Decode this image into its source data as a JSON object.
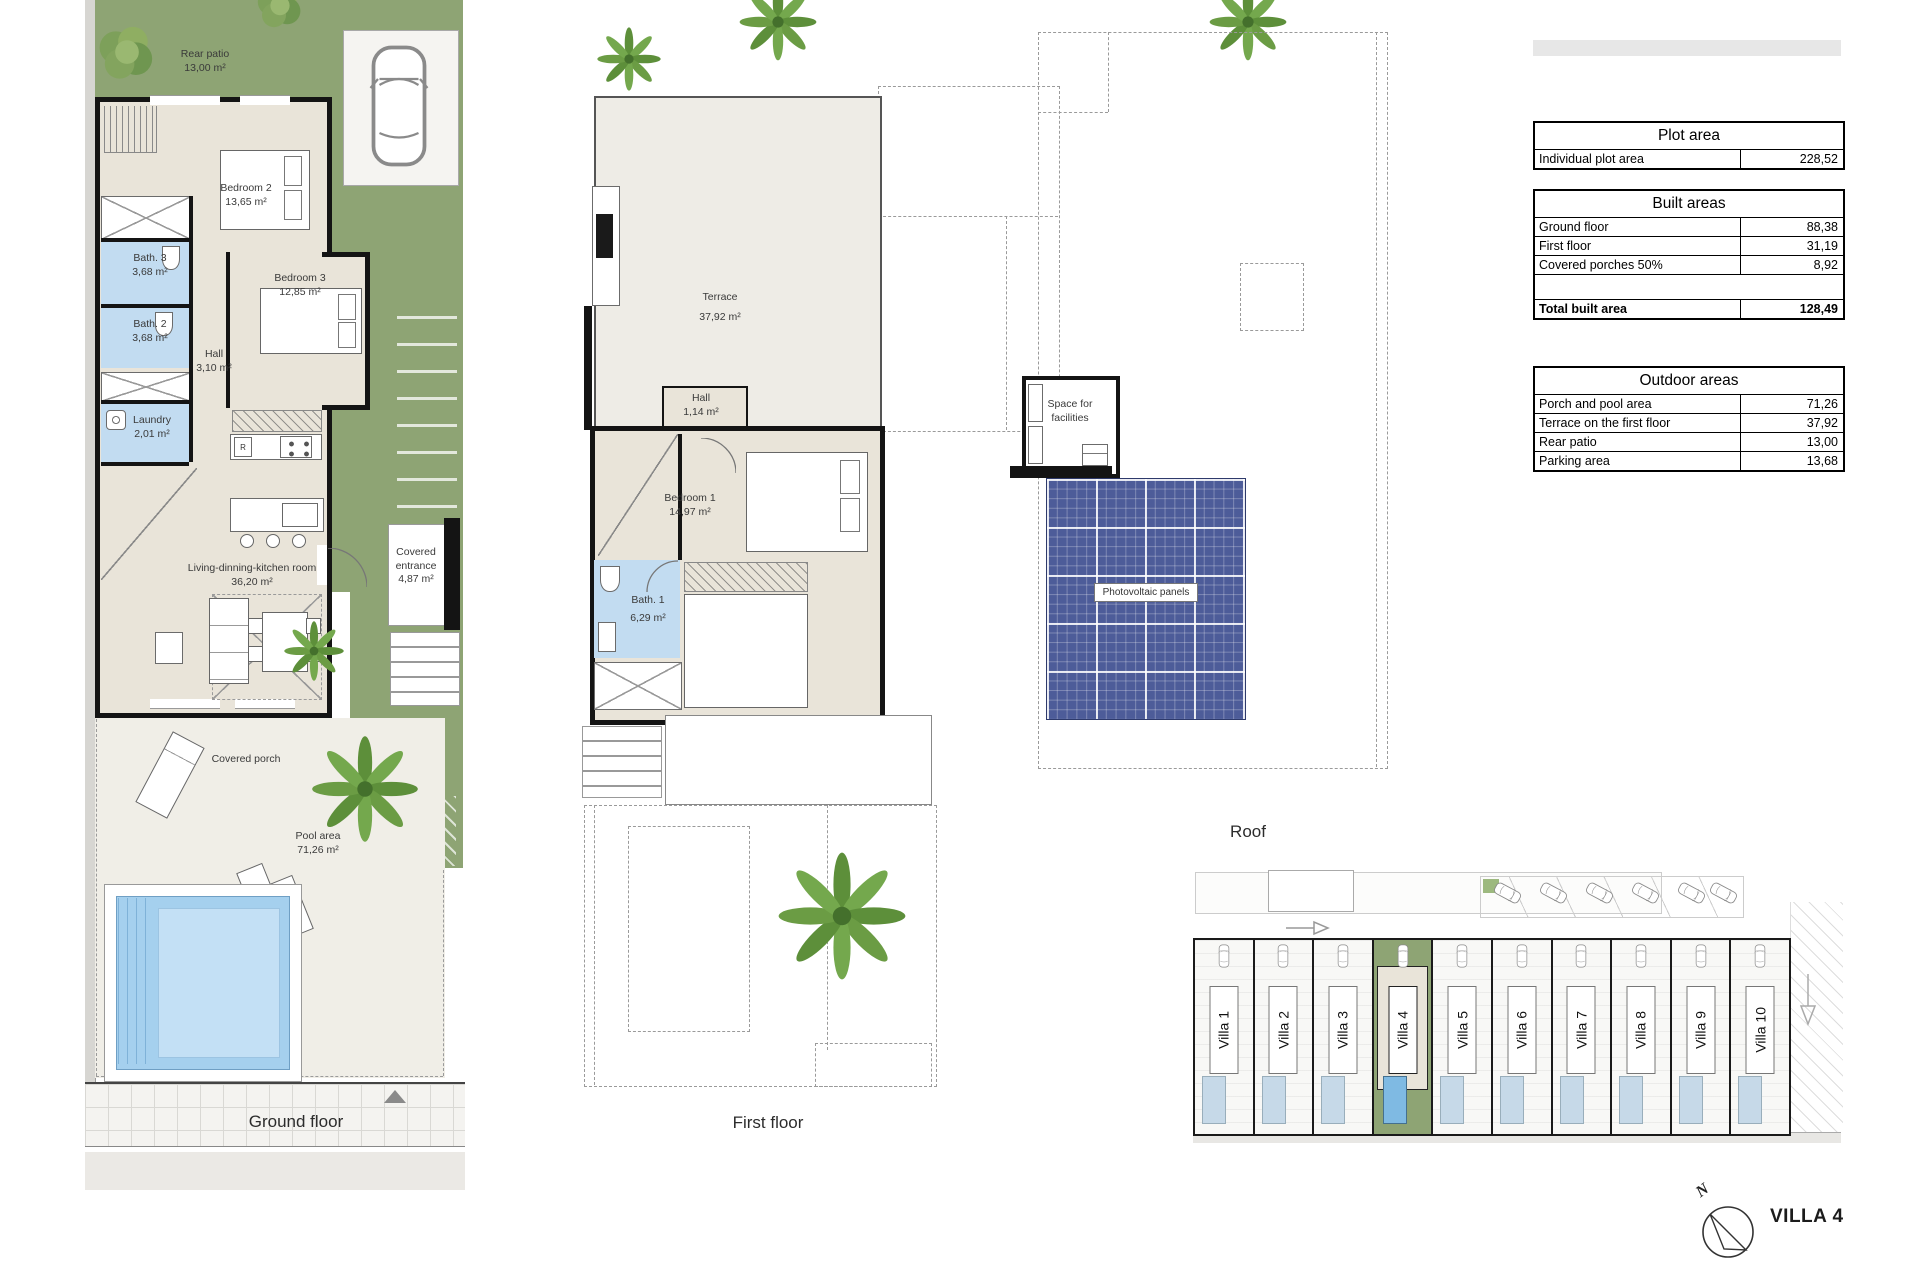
{
  "captions": {
    "ground_floor": "Ground floor",
    "first_floor": "First floor",
    "roof": "Roof"
  },
  "title": {
    "villa": "VILLA 4",
    "compass_north": "N"
  },
  "ground_floor": {
    "rear_patio": {
      "name": "Rear patio",
      "area": "13,00 m²"
    },
    "bedroom2": {
      "name": "Bedroom 2",
      "area": "13,65 m²"
    },
    "bath3": {
      "name": "Bath. 3",
      "area": "3,68 m²"
    },
    "bath2": {
      "name": "Bath. 2",
      "area": "3,68 m²"
    },
    "hall": {
      "name": "Hall",
      "area": "3,10 m²"
    },
    "bedroom3": {
      "name": "Bedroom 3",
      "area": "12,85 m²"
    },
    "laundry": {
      "name": "Laundry",
      "area": "2,01 m²"
    },
    "living": {
      "name": "Living-dinning-kitchen room",
      "area": "36,20 m²"
    },
    "covered_entrance": {
      "name": "Covered entrance",
      "area": "4,87 m²"
    },
    "covered_porch": {
      "name": "Covered porch"
    },
    "pool": {
      "name": "Pool area",
      "area": "71,26 m²"
    },
    "fridge": "R"
  },
  "first_floor": {
    "terrace": {
      "name": "Terrace",
      "area": "37,92 m²"
    },
    "hall": {
      "name": "Hall",
      "area": "1,14 m²"
    },
    "bedroom1": {
      "name": "Bedroom 1",
      "area": "14,97 m²"
    },
    "bath1": {
      "name": "Bath. 1",
      "area": "6,29 m²"
    }
  },
  "roof": {
    "facilities": "Space for facilities",
    "pv": "Photovoltaic panels"
  },
  "tables": {
    "plot": {
      "title": "Plot area",
      "rows": [
        {
          "label": "Individual plot area",
          "value": "228,52"
        }
      ]
    },
    "built": {
      "title": "Built areas",
      "rows": [
        {
          "label": "Ground floor",
          "value": "88,38"
        },
        {
          "label": "First floor",
          "value": "31,19"
        },
        {
          "label": "Covered porches 50%",
          "value": "8,92"
        }
      ],
      "total_label": "Total built area",
      "total_value": "128,49"
    },
    "outdoor": {
      "title": "Outdoor areas",
      "rows": [
        {
          "label": "Porch and pool area",
          "value": "71,26"
        },
        {
          "label": "Terrace on the first floor",
          "value": "37,92"
        },
        {
          "label": "Rear patio",
          "value": "13,00"
        },
        {
          "label": "Parking area",
          "value": "13,68"
        }
      ]
    }
  },
  "site_plan": {
    "villas": [
      "Villa 1",
      "Villa 2",
      "Villa 3",
      "Villa 4",
      "Villa 5",
      "Villa 6",
      "Villa 7",
      "Villa 8",
      "Villa 9",
      "Villa 10"
    ]
  },
  "colors": {
    "garden_green": "#8ea474",
    "bath_blue": "#c2dcf1",
    "pool_blue": "#a5d0ee",
    "pv_panel_blue": "#4d5c99"
  }
}
